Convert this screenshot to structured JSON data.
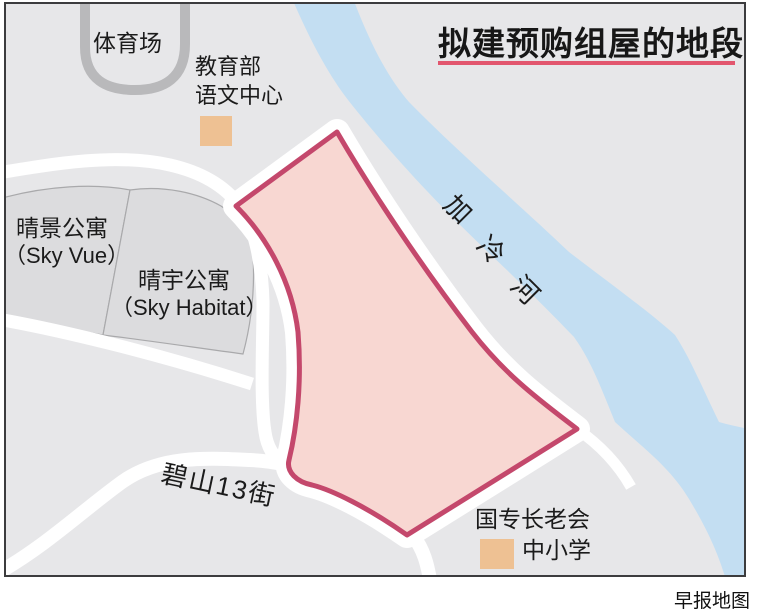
{
  "header": {
    "title": "拟建预购组屋的地段"
  },
  "places": {
    "stadium": "体育场",
    "moe_line1": "教育部",
    "moe_line2": "语文中心",
    "sky_vue_cn": "晴景公寓",
    "sky_vue_en": "（Sky Vue）",
    "sky_habitat_cn": "晴宇公寓",
    "sky_habitat_en": "（Sky Habitat）",
    "river": "加冷河",
    "road": "碧山13街",
    "school_line1": "国专长老会",
    "school_line2": "中小学"
  },
  "footer": {
    "credit": "早报地图"
  },
  "colors": {
    "background": "#e7e7e9",
    "parcel": "#dcdcde",
    "parcel_outline": "#a9a9ab",
    "stadium_track": "#b9b9bb",
    "road": "#ffffff",
    "river": "#c3def2",
    "site_fill": "#f8d7d2",
    "site_border": "#c4486c",
    "landmark_square": "#eec193",
    "title_underline": "#e2566e",
    "frame": "#3c3c3e"
  }
}
